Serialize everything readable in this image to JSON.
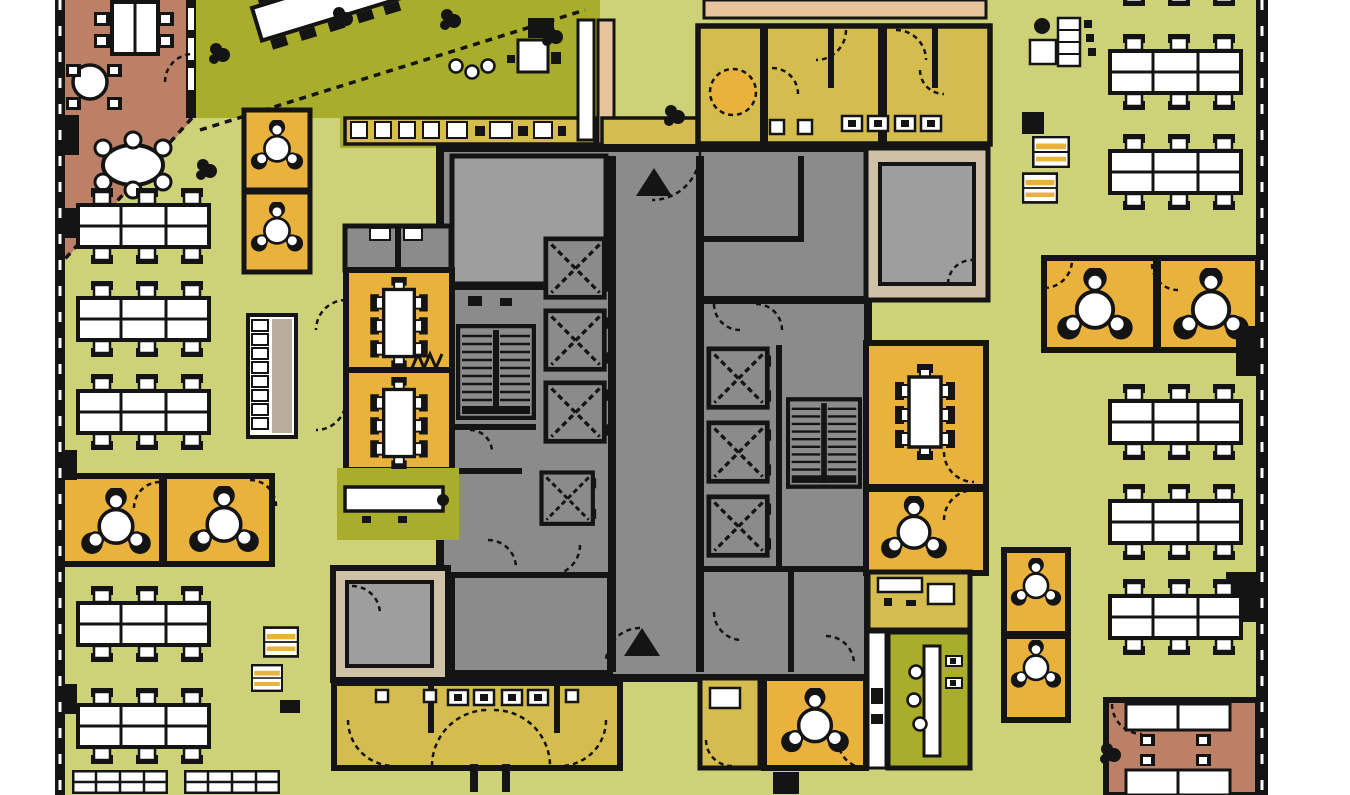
{
  "title": "office-floor-plan",
  "colors": {
    "floor": "#cdd178",
    "floor_dark": "#a8ad2b",
    "mustard": "#d4bd4e",
    "orange": "#e9b23d",
    "terracotta": "#bc8066",
    "beige": "#cfc0a8",
    "tan_light": "#e7c49c",
    "core": "#8b8b8b",
    "core_light": "#9e9e9e",
    "wall": "#141414",
    "paper": "#ffffff"
  },
  "legend": {
    "open_office": "open office benching",
    "meeting": "meeting rooms",
    "core": "building core / lifts / stairs",
    "wc": "washrooms",
    "cafe": "cafe / pantry",
    "executive": "enclosed offices"
  },
  "plan": {
    "banks": [
      [
        76,
        188
      ],
      [
        76,
        281
      ],
      [
        76,
        374
      ],
      [
        76,
        586
      ],
      [
        76,
        688
      ],
      [
        1108,
        -70
      ],
      [
        1108,
        34
      ],
      [
        1108,
        134
      ],
      [
        1108,
        384
      ],
      [
        1108,
        484
      ],
      [
        1108,
        579
      ]
    ],
    "grids4": [
      [
        72,
        770
      ],
      [
        184,
        770
      ]
    ],
    "elevators": [
      [
        543,
        236,
        66,
        66
      ],
      [
        543,
        308,
        66,
        66
      ],
      [
        543,
        380,
        66,
        66
      ],
      [
        527,
        470,
        82,
        58
      ],
      [
        706,
        345,
        66,
        68
      ],
      [
        706,
        419,
        66,
        68
      ],
      [
        706,
        493,
        66,
        68
      ]
    ],
    "stairs": [
      [
        456,
        324,
        80,
        96
      ],
      [
        786,
        397,
        76,
        92
      ]
    ],
    "lockers": [
      [
        1032,
        136,
        38,
        32
      ],
      [
        1022,
        172,
        36,
        32
      ],
      [
        263,
        624,
        36,
        36
      ],
      [
        251,
        664,
        32,
        28
      ]
    ],
    "pods3": [
      [
        250,
        120,
        54
      ],
      [
        250,
        202,
        54
      ],
      [
        80,
        488,
        72
      ],
      [
        188,
        486,
        72
      ],
      [
        1056,
        268,
        78
      ],
      [
        1172,
        268,
        78
      ],
      [
        1010,
        558,
        52
      ],
      [
        1010,
        640,
        52
      ],
      [
        780,
        688,
        70
      ],
      [
        880,
        496,
        68
      ]
    ],
    "tables8": [
      [
        367,
        277,
        64,
        92
      ],
      [
        367,
        377,
        64,
        92
      ],
      [
        893,
        355,
        64,
        114
      ]
    ],
    "wcpairs": [
      [
        840,
        114
      ],
      [
        893,
        114
      ],
      [
        446,
        688
      ],
      [
        500,
        688
      ]
    ],
    "stools": [
      [
        448,
        58
      ],
      [
        464,
        64
      ],
      [
        480,
        58
      ],
      [
        908,
        664
      ],
      [
        906,
        692
      ],
      [
        912,
        716
      ]
    ],
    "plants": [
      [
        207,
        42
      ],
      [
        438,
        8
      ],
      [
        194,
        158
      ],
      [
        1098,
        742
      ],
      [
        662,
        104
      ],
      [
        540,
        24
      ],
      [
        330,
        6
      ]
    ],
    "columns": [
      [
        1022,
        112,
        22,
        22
      ],
      [
        773,
        772,
        26,
        22
      ],
      [
        280,
        700,
        20,
        13
      ],
      [
        63,
        115,
        16,
        40
      ],
      [
        1236,
        326,
        24,
        50
      ],
      [
        1226,
        572,
        34,
        50
      ],
      [
        65,
        208,
        12,
        30
      ],
      [
        65,
        450,
        12,
        30
      ],
      [
        65,
        684,
        12,
        30
      ]
    ]
  }
}
